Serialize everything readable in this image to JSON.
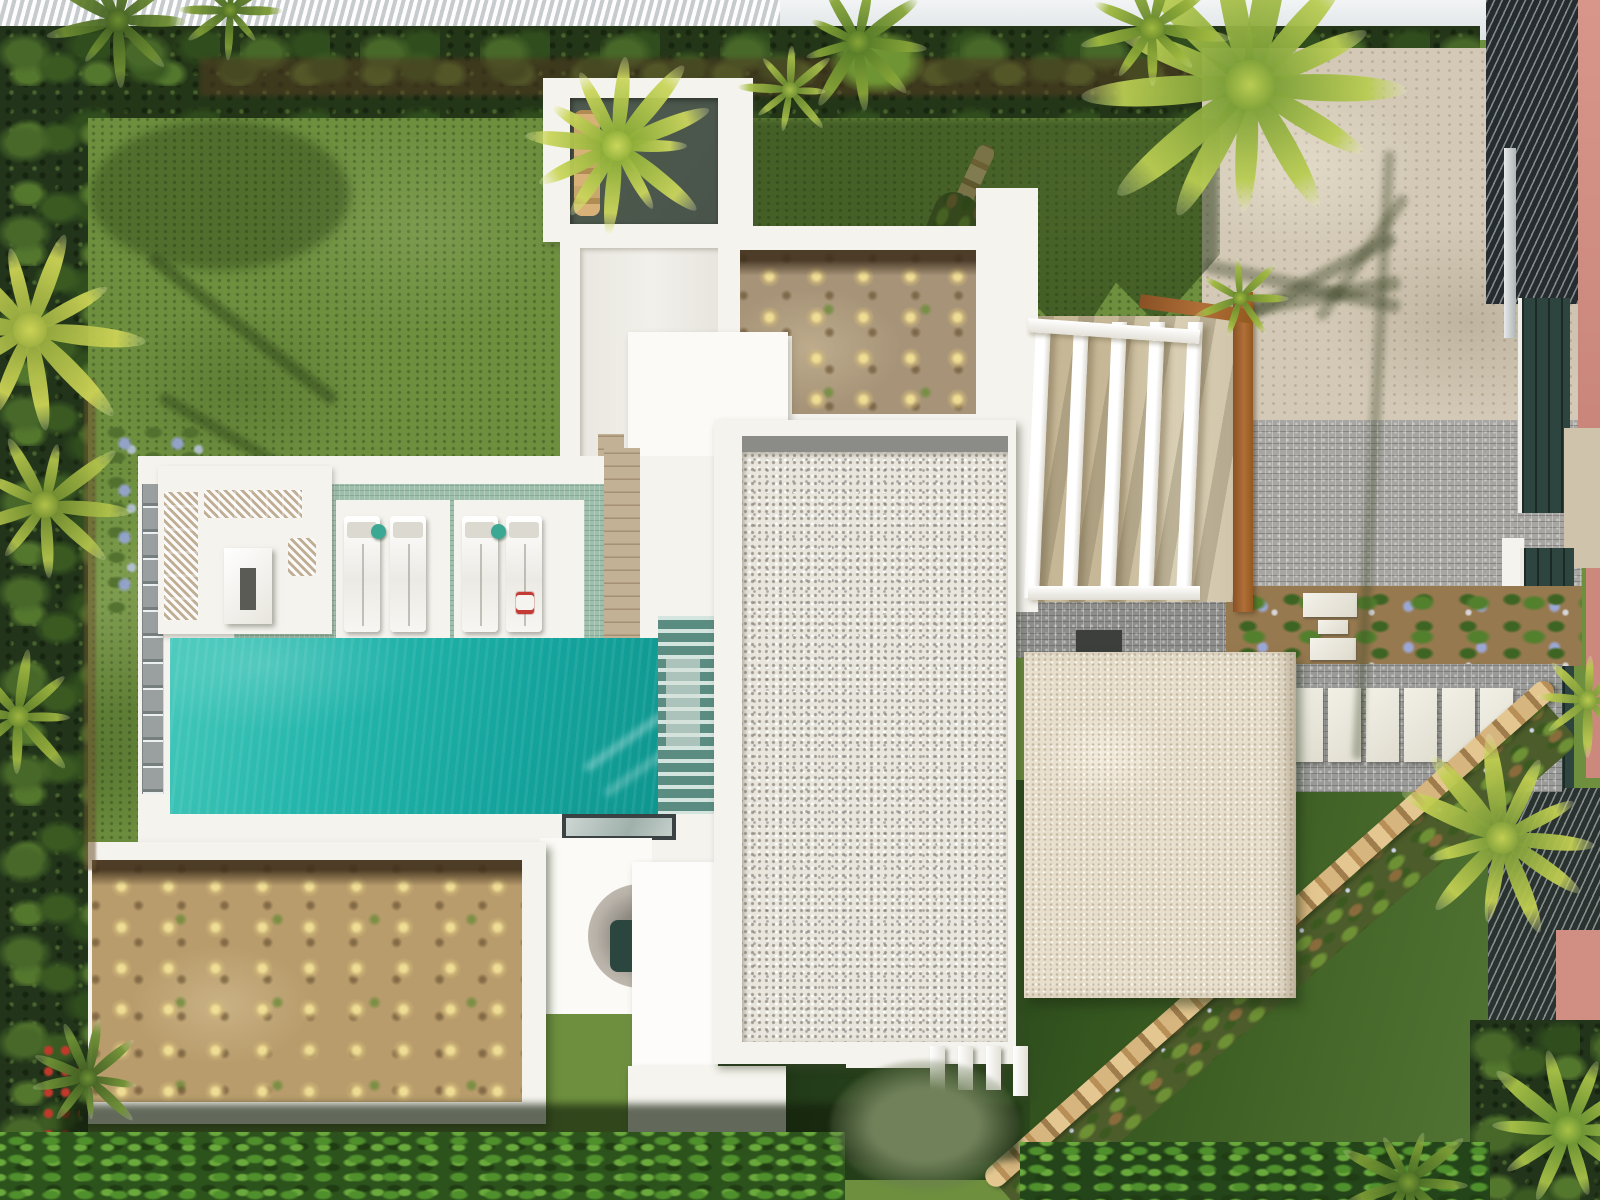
{
  "meta": {
    "kind": "aerial-drone-photograph",
    "subject": "modern white flat-roof villa with turquoise pool, gravel roofs, pergola and landscaped tropical garden",
    "view": "top-down"
  },
  "palette": {
    "lawn": "#6d8f3e",
    "hedge": "#22351a",
    "white": "#f5f3ee",
    "gravel": "#e9e6dd",
    "beigeBlock": "#e7decc",
    "patio": "#d3c9b6",
    "cobble": "#a8a6a2",
    "soil": "#b89c6c",
    "sage": "#9dbfab",
    "pool": "#18ada4",
    "corten": "#a0622f",
    "salmon": "#d18e81",
    "louver": "#252b2e",
    "tealGate": "#2e443f",
    "wood": "#c2b194"
  },
  "scene": {
    "pool": {
      "color": "#18ada4",
      "lounger_count": 4,
      "side_table_count": 2,
      "side_table_color": "#3aa893"
    },
    "pergola": {
      "beam_count": 5,
      "beams": {
        "x0": 1030,
        "step": 38,
        "w": 15,
        "y": 322,
        "h": 276
      }
    },
    "stepping_slabs": {
      "count": 6,
      "x0": 1290,
      "y": 688,
      "w": 33,
      "h": 74,
      "gap": 5
    },
    "roof_fins": {
      "xs": [
        930,
        958,
        986,
        1013
      ],
      "hs": [
        52,
        44,
        44,
        50
      ],
      "y": 1046,
      "w": 15
    },
    "loungers": {
      "xs": [
        344,
        390,
        462,
        506
      ],
      "y": 516,
      "w": 36,
      "h": 116
    },
    "side_tables": [
      {
        "x": 371,
        "y": 524
      },
      {
        "x": 491,
        "y": 524
      }
    ],
    "planted_bed_count": 2,
    "palms": [
      {
        "x": 617,
        "y": 146,
        "r": 100,
        "c1": "#7fa52f",
        "c2": "#cbd65c",
        "n": 12
      },
      {
        "x": 1250,
        "y": 85,
        "r": 165,
        "c1": "#6d9431",
        "c2": "#b9cc52",
        "n": 13
      },
      {
        "x": 1152,
        "y": 28,
        "r": 80,
        "c1": "#5d8029",
        "c2": "#9fb83e",
        "n": 9
      },
      {
        "x": 858,
        "y": 42,
        "r": 72,
        "c1": "#4f7526",
        "c2": "#86a437",
        "n": 9
      },
      {
        "x": 790,
        "y": 90,
        "r": 52,
        "c1": "#5d8029",
        "c2": "#a7bd4a",
        "n": 8
      },
      {
        "x": 30,
        "y": 330,
        "r": 115,
        "c1": "#8ea43b",
        "c2": "#ccd355",
        "n": 10
      },
      {
        "x": 45,
        "y": 505,
        "r": 85,
        "c1": "#68852c",
        "c2": "#b1c24a",
        "n": 9
      },
      {
        "x": 18,
        "y": 716,
        "r": 70,
        "c1": "#5c7e2a",
        "c2": "#9eb53f",
        "n": 8
      },
      {
        "x": 1502,
        "y": 838,
        "r": 105,
        "c1": "#6e9134",
        "c2": "#c2cf52",
        "n": 11
      },
      {
        "x": 1568,
        "y": 1130,
        "r": 92,
        "c1": "#5e8a2f",
        "c2": "#a9c247",
        "n": 10
      },
      {
        "x": 1408,
        "y": 1182,
        "r": 70,
        "c1": "#3f6322",
        "c2": "#7d9c35",
        "n": 9
      },
      {
        "x": 1588,
        "y": 700,
        "r": 58,
        "c1": "#6e9134",
        "c2": "#b9c94e",
        "n": 8
      },
      {
        "x": 1240,
        "y": 298,
        "r": 48,
        "c1": "#5d8029",
        "c2": "#9fb83e",
        "n": 7
      },
      {
        "x": 118,
        "y": 20,
        "r": 75,
        "c1": "#3c5a20",
        "c2": "#6d8c30",
        "n": 9
      },
      {
        "x": 230,
        "y": 10,
        "r": 55,
        "c1": "#42621f",
        "c2": "#7d9c35",
        "n": 8
      },
      {
        "x": 88,
        "y": 1078,
        "r": 60,
        "c1": "#3c5a20",
        "c2": "#6f9135",
        "n": 9
      }
    ]
  }
}
